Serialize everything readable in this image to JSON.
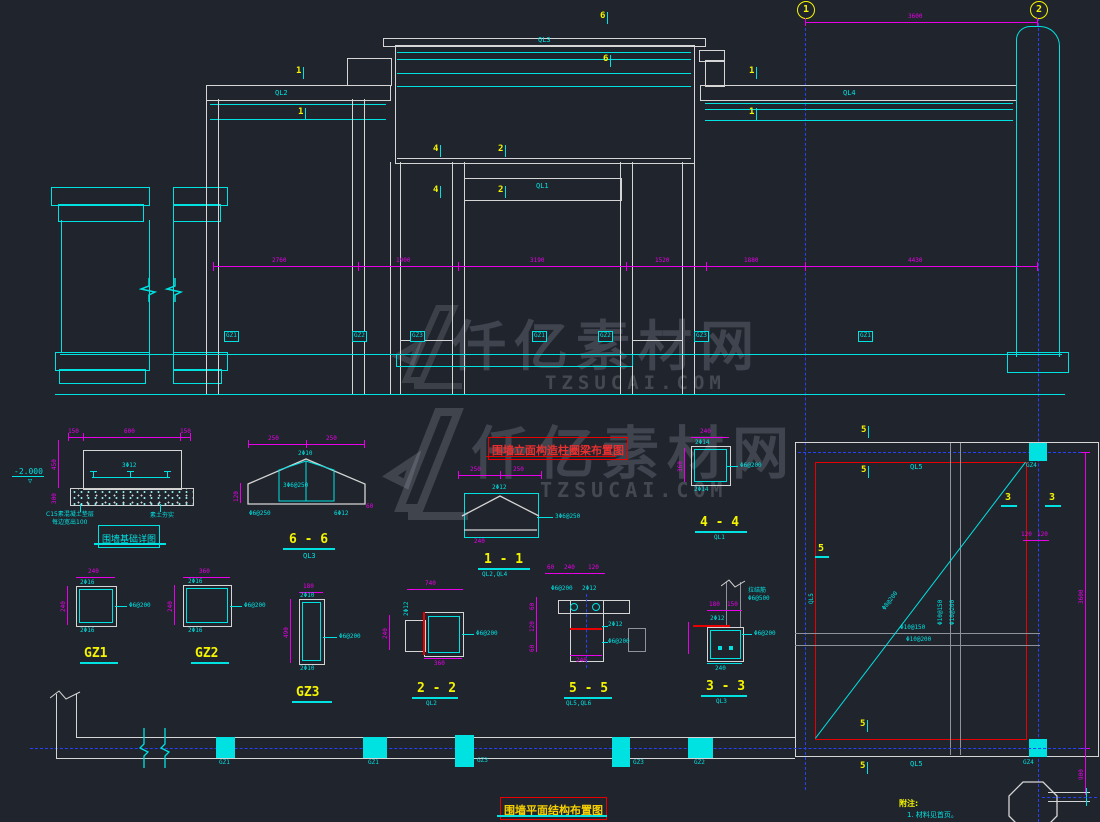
{
  "titles": {
    "elevation": "围墙立面构造柱圈梁布置图",
    "foundation": "围墙基础详图",
    "plan": "围墙平面结构布置图"
  },
  "watermark": {
    "brand": "仟亿素材网",
    "site": "TZSUCAI.COM"
  },
  "axes": {
    "n1": "1",
    "n2": "2",
    "dim": "3600"
  },
  "notes": {
    "head": "附注:",
    "line1": "1. 材料见首页。"
  },
  "elevation": {
    "ql1": "QL1",
    "ql2": "QL2",
    "ql3": "QL3",
    "ql4": "QL4",
    "m6a": "6",
    "m6b": "6",
    "m1a": "1",
    "m1b": "1",
    "m1c": "1",
    "m1d": "1",
    "m4a": "4",
    "m2a": "2",
    "m4b": "4",
    "m2b": "2",
    "gz": [
      "GZ1",
      "GZ2",
      "GZ3",
      "GZ1",
      "GZ2",
      "GZ3",
      "GZ1"
    ],
    "dims": [
      "2760",
      "1900",
      "3190",
      "1520",
      "1880",
      "4430"
    ]
  },
  "foundation": {
    "dt1": "150",
    "dt2": "600",
    "dt3": "150",
    "dl1": "450",
    "dl2": "300",
    "rebar": "3Φ12",
    "note1": "C15素混凝土垫层",
    "note2": "每边宽出100",
    "note3": "素土夯实",
    "level": "-2.000"
  },
  "s66": {
    "label": "6 - 6",
    "sub": "QL3",
    "d1": "250",
    "d2": "250",
    "t1": "2Φ10",
    "t2": "3Φ6@250",
    "dl": "120",
    "b1": "Φ6@250",
    "b2": "6Φ12",
    "dr": "60"
  },
  "s11": {
    "label": "1 - 1",
    "sub": "QL2,QL4",
    "d1": "250",
    "d2": "250",
    "t1": "2Φ12",
    "r1": "3Φ6@250",
    "db": "240"
  },
  "s44": {
    "label": "4 - 4",
    "sub": "QL1",
    "dt": "240",
    "dl": "360",
    "t1": "2Φ14",
    "b1": "2Φ14",
    "r1": "Φ6@200"
  },
  "gz1": {
    "label": "GZ1",
    "dt": "240",
    "dl": "240",
    "t1": "2Φ16",
    "b1": "2Φ16",
    "r1": "Φ6@200"
  },
  "gz2": {
    "label": "GZ2",
    "dt": "360",
    "dl": "240",
    "t1": "2Φ16",
    "b1": "2Φ16",
    "r1": "Φ6@200"
  },
  "gz3": {
    "label": "GZ3",
    "dt": "180",
    "dl": "490",
    "t1": "2Φ10",
    "b1": "2Φ10",
    "r1": "Φ6@200"
  },
  "s22": {
    "label": "2 - 2",
    "sub": "QL2",
    "dt": "740",
    "dl": "240",
    "db": "360",
    "t1": "2Φ12",
    "r1": "Φ6@200"
  },
  "s55": {
    "label": "5 - 5",
    "sub": "QL5,QL6",
    "dt1": "60",
    "dt2": "240",
    "dt3": "120",
    "t1": "Φ6@200",
    "t2": "2Φ12",
    "r1": "2Φ12",
    "r2": "Φ6@200",
    "db": "240",
    "dl1": "60",
    "dl2": "120",
    "dl3": "60"
  },
  "s33": {
    "label": "3 - 3",
    "sub": "QL3",
    "d1": "180",
    "d2": "150",
    "t1": "2Φ12",
    "n1": "拉结筋",
    "n2": "Φ6@500",
    "r1": "Φ6@200",
    "db": "240"
  },
  "plan": {
    "gz4a": "GZ4",
    "gz4b": "GZ4",
    "ql5a": "QL5",
    "ql5b": "QL5",
    "ql5c": "QL5",
    "m5a": "5",
    "m5b": "5",
    "m5c": "5",
    "m5d": "5",
    "m5e": "5",
    "m3a": "3",
    "m3b": "3",
    "bar1": "Φ10@150",
    "bar2": "Φ10@200",
    "bar3": "Φ10@150",
    "bar4": "Φ10@200",
    "diag": "Φ8@200",
    "dimr": "3600",
    "ds1": "120",
    "ds2": "120",
    "dbr": "900"
  },
  "strip": {
    "gz1": "GZ1",
    "gz2": "GZ1",
    "gz3": "GZ3",
    "gz4": "GZ3",
    "gz5": "GZ2"
  }
}
